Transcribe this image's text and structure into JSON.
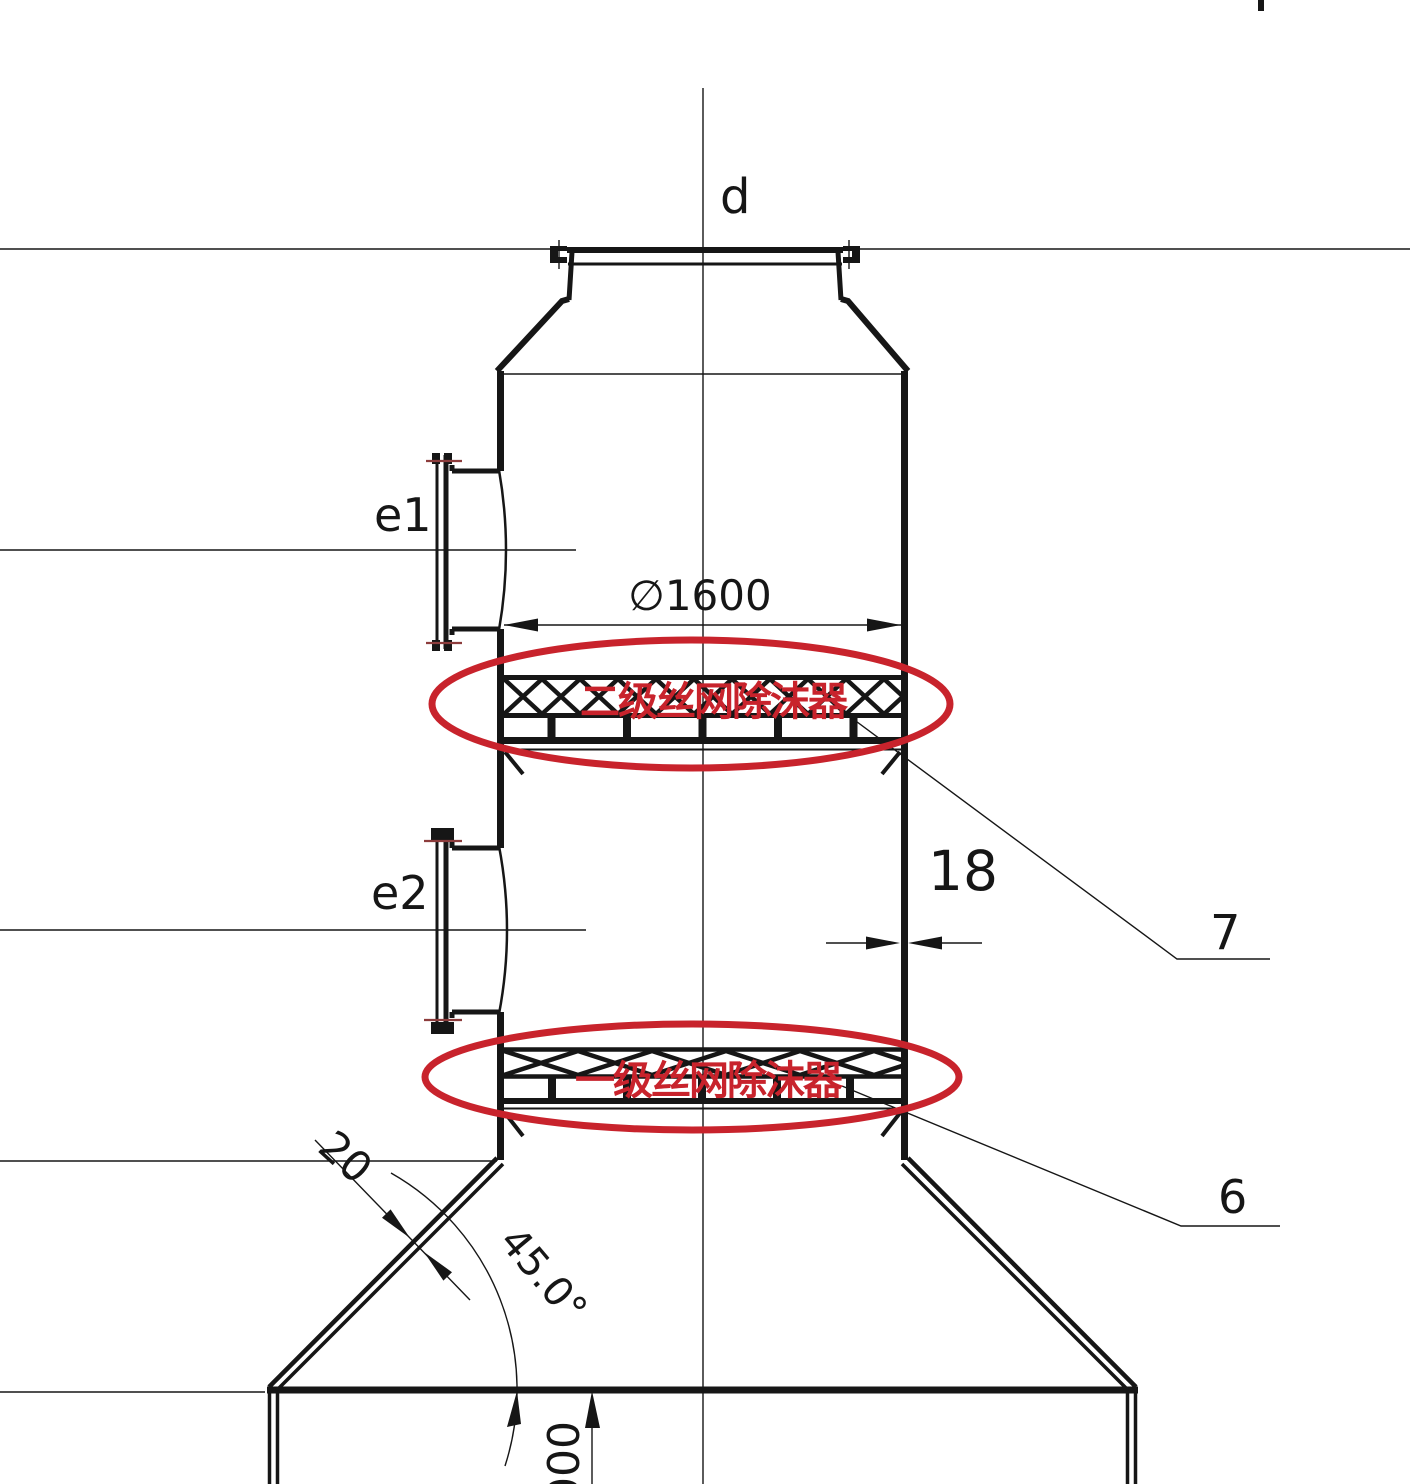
{
  "labels": {
    "top_nozzle": "d",
    "nozzle_e1": "e1",
    "nozzle_e2": "e2",
    "shell_diameter": "∅1600",
    "shell_wall_thickness": "18",
    "item_upper": "7",
    "item_lower": "6",
    "cone_wall_thickness": "20",
    "cone_angle": "45.0°",
    "bottom_dim_partial": "000"
  },
  "annotations": {
    "upper_demister_label": "二级丝网除沫器",
    "lower_demister_label": "一级丝网除沫器"
  },
  "colors": {
    "ink": "#161616",
    "red": "#c8232c",
    "tickred": "#8d3c3c"
  }
}
